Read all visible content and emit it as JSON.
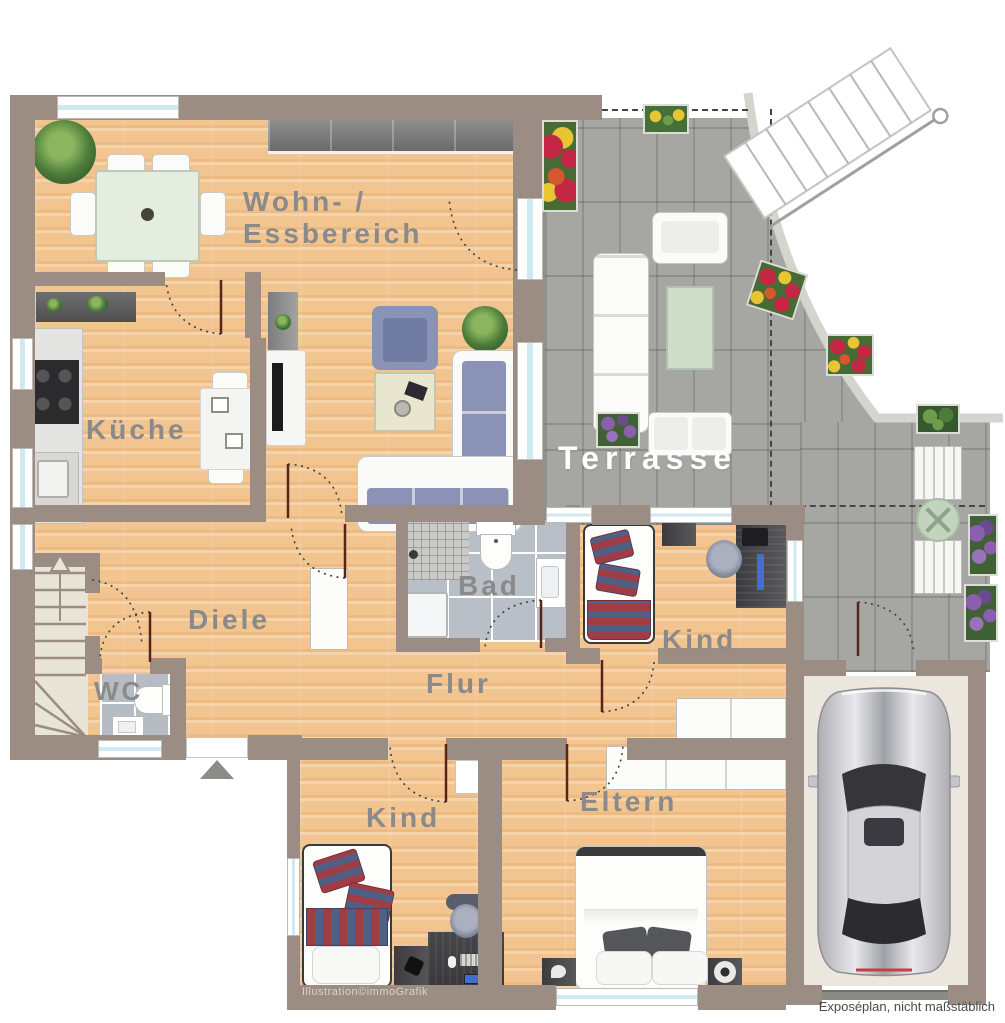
{
  "rooms": {
    "living_dining_line1": "Wohn- /",
    "living_dining_line2": "Essbereich",
    "kitchen": "Küche",
    "terrace": "Terrasse",
    "hallway": "Diele",
    "wc": "WC",
    "bathroom": "Bad",
    "corridor": "Flur",
    "child_room_right": "Kind",
    "child_room_bottom": "Kind",
    "parents_room": "Eltern"
  },
  "footer": {
    "right": "Exposéplan, nicht maßstäblich",
    "credit": "Illustration©immoGrafik"
  },
  "palette": {
    "wall": "#9b8d83",
    "wood_floor": "#f2c48f",
    "terrace_tile": "#a6a6a2",
    "bath_tile": "#b9bfc7",
    "stairs_floor": "#e9e4d8",
    "garage_floor": "#ebe7de",
    "label_grey": "#8a8a8a",
    "label_white": "#ffffff",
    "door_leaf": "#5c2419",
    "window_glass": "#cfe9f2",
    "sofa_blue": "#8a93b6",
    "stripe_red": "#a03c46",
    "stripe_blue": "#4f5f85",
    "car_silver": "#c9c9cd"
  }
}
